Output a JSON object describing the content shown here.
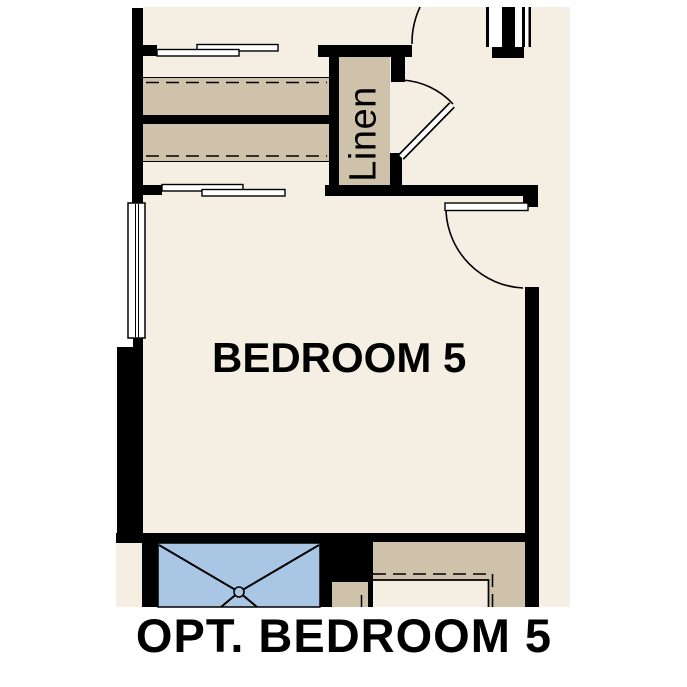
{
  "title": "OPT. BEDROOM 5",
  "plan": {
    "room_label": "BEDROOM 5",
    "closet_label": "Linen"
  },
  "colors": {
    "floor": "#f5eee3",
    "tan": "#cec2ab",
    "blue": "#a9c6e4",
    "wall": "#000000",
    "bg": "#ffffff",
    "text": "#000000"
  }
}
